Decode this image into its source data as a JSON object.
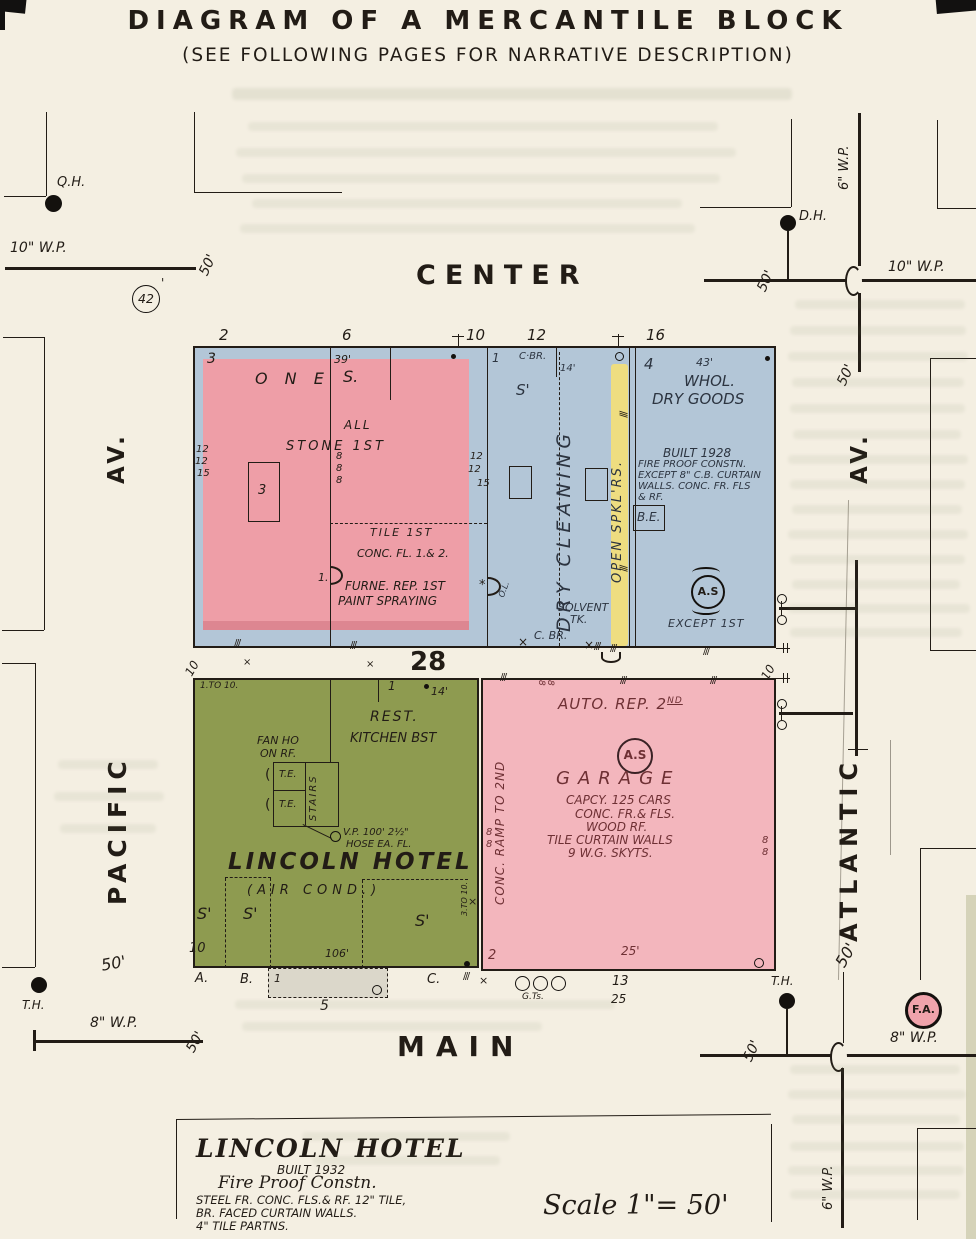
{
  "title": {
    "main": "DIAGRAM OF A MERCANTILE BLOCK",
    "sub": "(SEE FOLLOWING PAGES FOR NARRATIVE DESCRIPTION)"
  },
  "streets": {
    "north": "CENTER",
    "south": "MAIN",
    "west": "PACIFIC",
    "west_av": "AV.",
    "east": "ATLANTIC",
    "east_av": "AV."
  },
  "block_badge": "42",
  "dist": "50'",
  "pipes": {
    "nw": "10\" W.P.",
    "ne": "10\" W.P.",
    "ne_v": "6\" W.P.",
    "sw": "8\" W.P.",
    "se": "8\" W.P.",
    "se_v": "6\" W.P."
  },
  "hydrants": {
    "qh": "Q.H.",
    "dh": "D.H.",
    "th_w": "T.H.",
    "th_e": "T.H.",
    "fa": "F.A."
  },
  "north_block": {
    "street_nos": [
      "2",
      "6",
      "10",
      "12",
      "16"
    ],
    "store": {
      "corner_no": "3",
      "width": "39'",
      "one": "O N E",
      "s": "S.",
      "all": "ALL",
      "stone": "STONE  1ST",
      "skylight": "3",
      "w_left": [
        "12",
        "12",
        "15"
      ],
      "w_mid": [
        "12",
        "12",
        "15"
      ],
      "e8": [
        "8",
        "8",
        "8"
      ],
      "tile": "TILE  1ST",
      "conc": "CONC. FL. 1.& 2.",
      "one_pt": "1.",
      "furne": "FURNE. REP. 1ST",
      "paint": "PAINT SPRAYING"
    },
    "cleaning": {
      "no": "1",
      "cbr": "C·BR.",
      "w14": "14'",
      "s": "S'",
      "name": "DRY CLEANING",
      "spk": "OPEN SPKL'RS.",
      "ol": "O.L.",
      "solvent": "SOLVENT",
      "tk": "TK.",
      "cbr2": "C.  BR."
    },
    "whol": {
      "no": "4",
      "width": "43'",
      "n1": "WHOL.",
      "n2": "DRY GOODS",
      "b1": "BUILT 1928",
      "b2": "FIRE PROOF CONSTN.",
      "b3": "EXCEPT 8\" C.B. CURTAIN",
      "b4": "WALLS. CONC. FR. FLS",
      "b5": "& RF.",
      "be": "B.E.",
      "as": "A.S",
      "except": "EXCEPT 1ST"
    }
  },
  "alley": {
    "no": "28",
    "w": "10"
  },
  "hotel": {
    "rng": "1.TO 10.",
    "no": "1",
    "w14": "14'",
    "rest": "REST.",
    "kitchen": "KITCHEN BST",
    "fan1": "FAN HO",
    "fan2": "ON RF.",
    "te": "T.E.",
    "stairs": "STAIRS",
    "vp": "V.P. 100' 2½\"",
    "hose": "HOSE EA. FL.",
    "name": "LINCOLN HOTEL",
    "air": "(AIR  COND.)",
    "s": "S'",
    "ten": "10",
    "w106": "106'",
    "a": "A.",
    "b": "B.",
    "c": "C.",
    "rng2": "3.TO 10.",
    "m1": "1",
    "m5": "5"
  },
  "garage": {
    "auto": "AUTO. REP. 2",
    "auto_sup": "ND",
    "as": "A.S",
    "name": "GARAGE",
    "capcy": "CAPCY. 125 CARS",
    "conc": "CONC. FR.& FLS.",
    "wood": "WOOD RF.",
    "tile": "TILE CURTAIN WALLS",
    "skyts": "9 W.G. SKYTS.",
    "ramp": "CONC. RAMP TO 2ND",
    "e8": "8",
    "two": "2",
    "w25": "25'",
    "gts": "G.Ts.",
    "n13": "13",
    "n25": "25"
  },
  "legend": {
    "name": "LINCOLN HOTEL",
    "built": "BUILT 1932",
    "fp": "Fire Proof Constn.",
    "l1": "STEEL FR. CONC. FLS.& RF. 12\" TILE,",
    "l2": "BR. FACED CURTAIN WALLS.",
    "l3": "4\" TILE PARTNS.",
    "scale": "Scale 1\"= 50'"
  },
  "colors": {
    "paper": "#f4efe2",
    "blue": "#b3c6d7",
    "pink_brick": "#ee9ea7",
    "pink_dark": "#dd8691",
    "pink_garage": "#f3b6bd",
    "yellow": "#eedd80",
    "green": "#8e9b50",
    "ink": "#221c16",
    "garage_ink": "#6e3034",
    "fa_fill": "#f0a3ab"
  }
}
